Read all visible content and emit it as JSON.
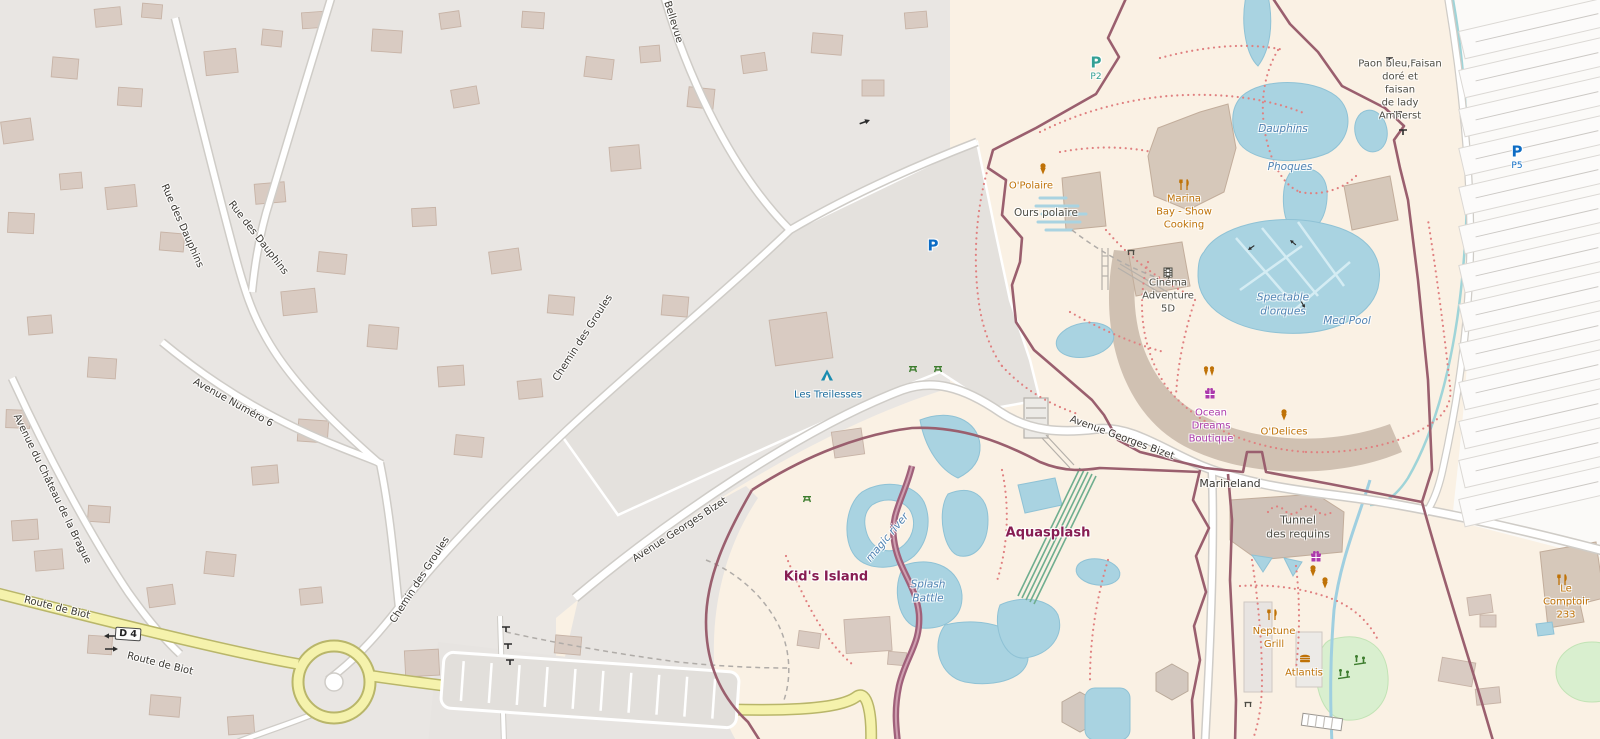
{
  "map": {
    "streets": {
      "bellevue": "Bellevue",
      "rue_des_dauphins_1": "Rue des Dauphins",
      "rue_des_dauphins_2": "Rue des Dauphins",
      "avenue_numero_6": "Avenue Numéro 6",
      "avenue_du_chateau": "Avenue du Château de la Brague",
      "route_de_biot_1": "Route de Biot",
      "route_de_biot_2": "Route de Biot",
      "chemin_des_groules_1": "Chemin des Groules",
      "chemin_des_groules_2": "Chemin des Groules",
      "avenue_georges_bizet_1": "Avenue Georges Bizet",
      "avenue_georges_bizet_2": "Avenue Georges Bizet",
      "marineland_road": "Marineland",
      "road_ref_badge": "D 4"
    },
    "attractions": {
      "kids_island": "Kid's Island",
      "aquasplash": "Aquasplash",
      "tunnel_des_requins": "Tunnel\ndes requins",
      "ours_polaire": "Ours polaire",
      "paon_enclosure": "Paon bleu,Faisan\ndoré et\nfaisan\nde lady\nAmherst",
      "cinema": "Cinéma\nAdventure\n5D",
      "les_treilesses": "Les Treilesses"
    },
    "amenities": {
      "o_polaire": "O'Polaire",
      "marina_bay": "Marina\nBay - Show\nCooking",
      "o_delices": "O'Delices",
      "neptune_grill": "Neptune\nGrill",
      "atlantis": "Atlantis",
      "le_comptoir_233": "Le Comptoir\n233",
      "ocean_dreams_boutique": "Ocean\nDreams\nBoutique"
    },
    "water_labels": {
      "dauphins": "Dauphins",
      "phoques": "Phoques",
      "spectacle_orques": "Spectable\nd'orques",
      "med_pool": "Med Pool",
      "splash_battle": "Splash\nBattle",
      "magic_river": "magic river"
    },
    "parking": {
      "p_main": "P",
      "p2": {
        "letter": "P",
        "ref": "P2"
      },
      "p5": {
        "letter": "P",
        "ref": "P5"
      }
    },
    "colors": {
      "water": "#a9d3e1",
      "park_fill": "#faf1e4",
      "park_boundary": "#9a5f6e",
      "attraction_label": "#871d52",
      "food_poi": "#bf7207",
      "shop_poi": "#ac39ac",
      "water_label": "#5083b3",
      "parking_blue": "#0d6cc4",
      "parking_teal": "#33a095",
      "main_road_yellow": "#f5f2ac"
    }
  }
}
